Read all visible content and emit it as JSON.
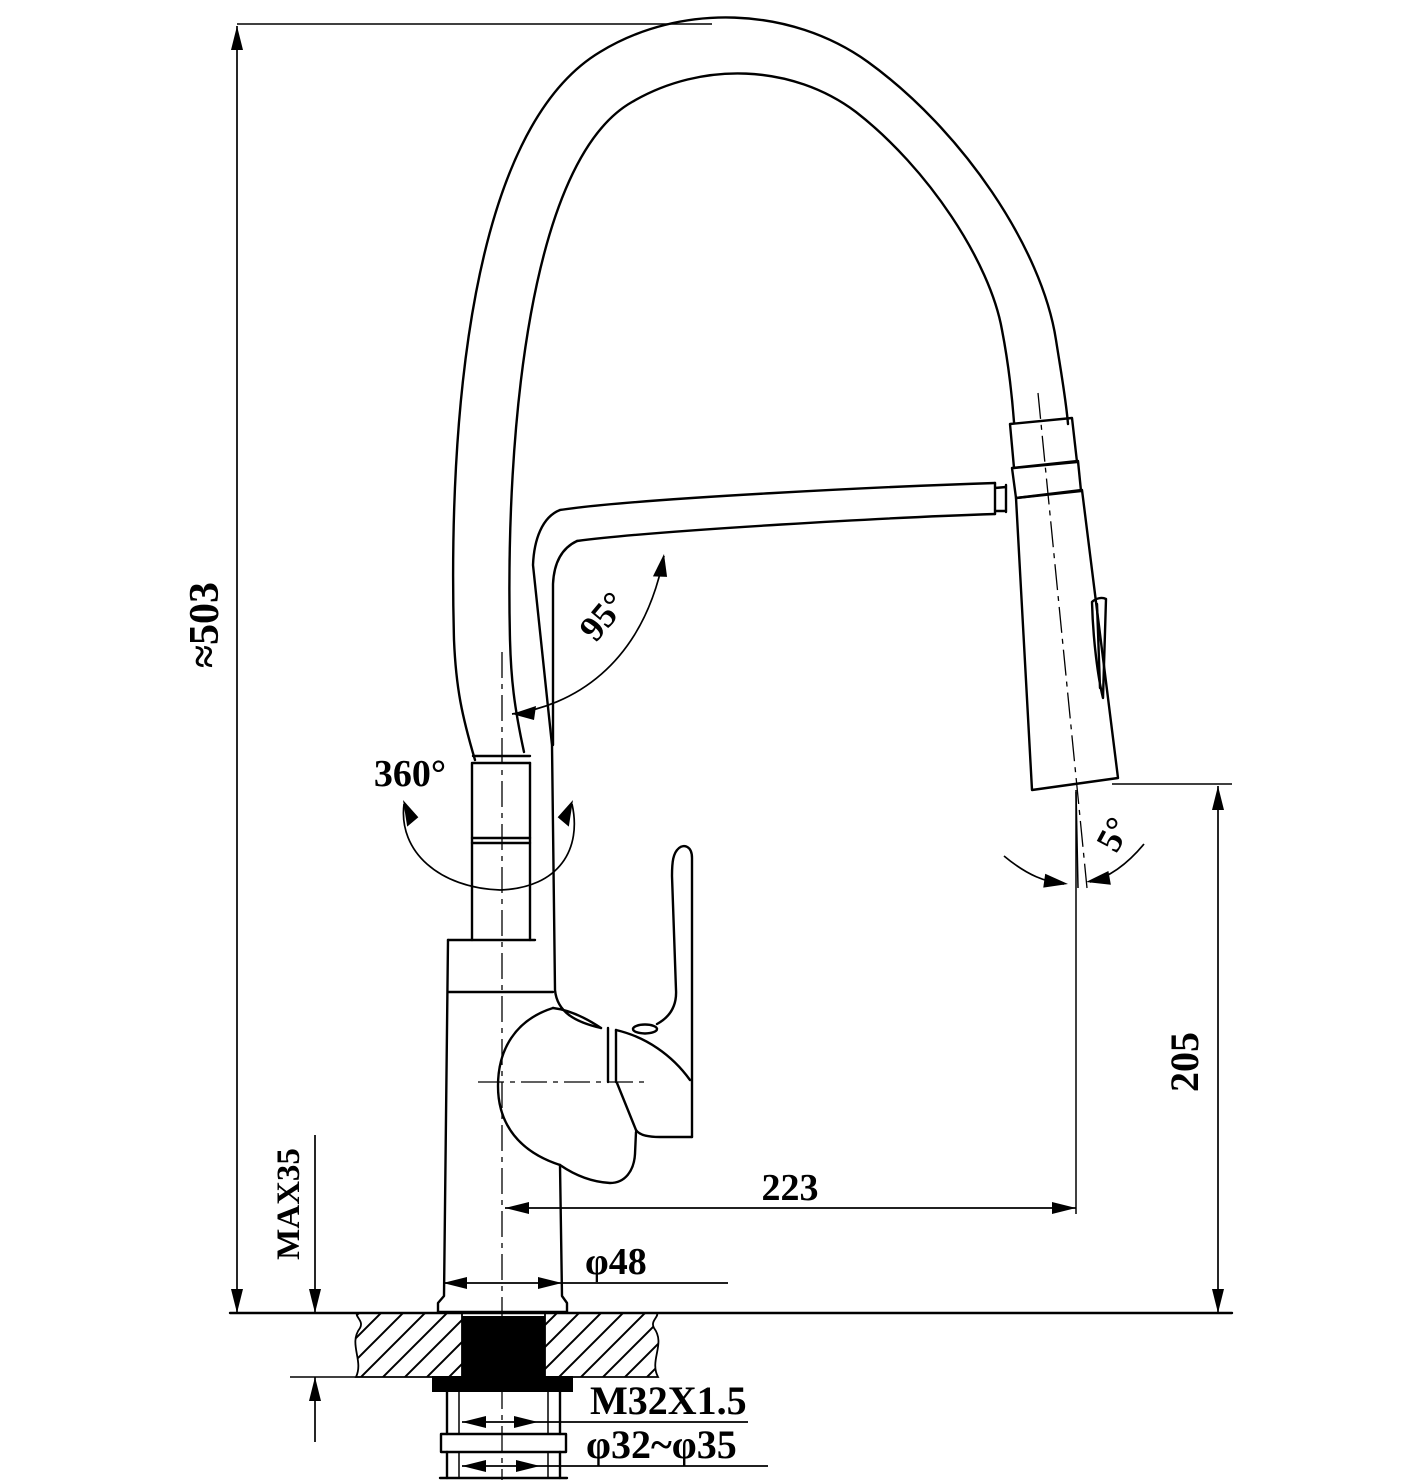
{
  "drawing": {
    "type": "technical-dimension-drawing",
    "subject": "pull-down kitchen faucet installation drawing",
    "line_color": "#000000",
    "background_color": "#ffffff",
    "labels": {
      "overall_height": "≈503",
      "swivel": "360°",
      "spout_angle": "95°",
      "head_tilt": "5°",
      "reach": "223",
      "outlet_height": "205",
      "max_deck_thickness": "MAX35",
      "base_diameter": "φ48",
      "mounting_thread": "M32X1.5",
      "hole_diameter": "φ32~φ35"
    }
  }
}
